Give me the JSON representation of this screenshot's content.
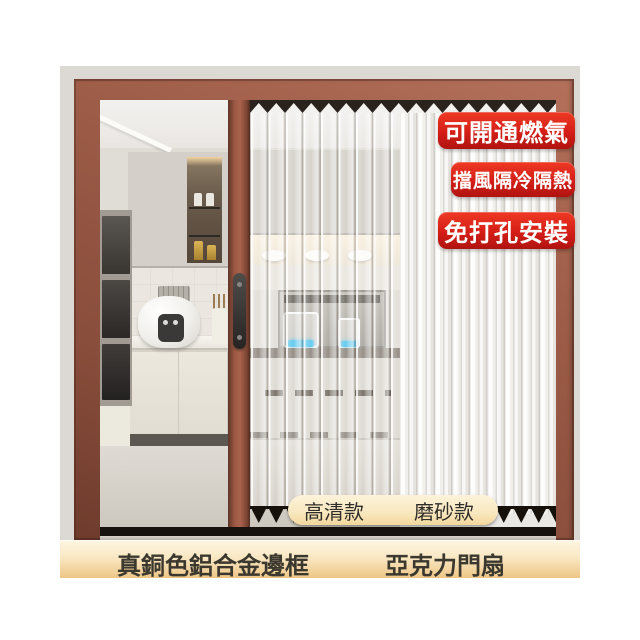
{
  "product_photo": {
    "description": "folding accordion door installed on kitchen doorway",
    "badges": [
      {
        "label": "可開通燃氣"
      },
      {
        "label": "擋風隔冷隔熱"
      },
      {
        "label": "免打孔安裝"
      }
    ],
    "variants": {
      "clear": "高清款",
      "frosted": "磨砂款"
    },
    "captions": {
      "frame": "真銅色鋁合金邊框",
      "panel": "亞克力門扇"
    },
    "colors": {
      "badge_red": "#d41e17",
      "frame_copper": "#8a4e3c",
      "caption_gold": "#eec685",
      "pill_cream": "#f9e9c2",
      "background": "#ffffff"
    }
  }
}
